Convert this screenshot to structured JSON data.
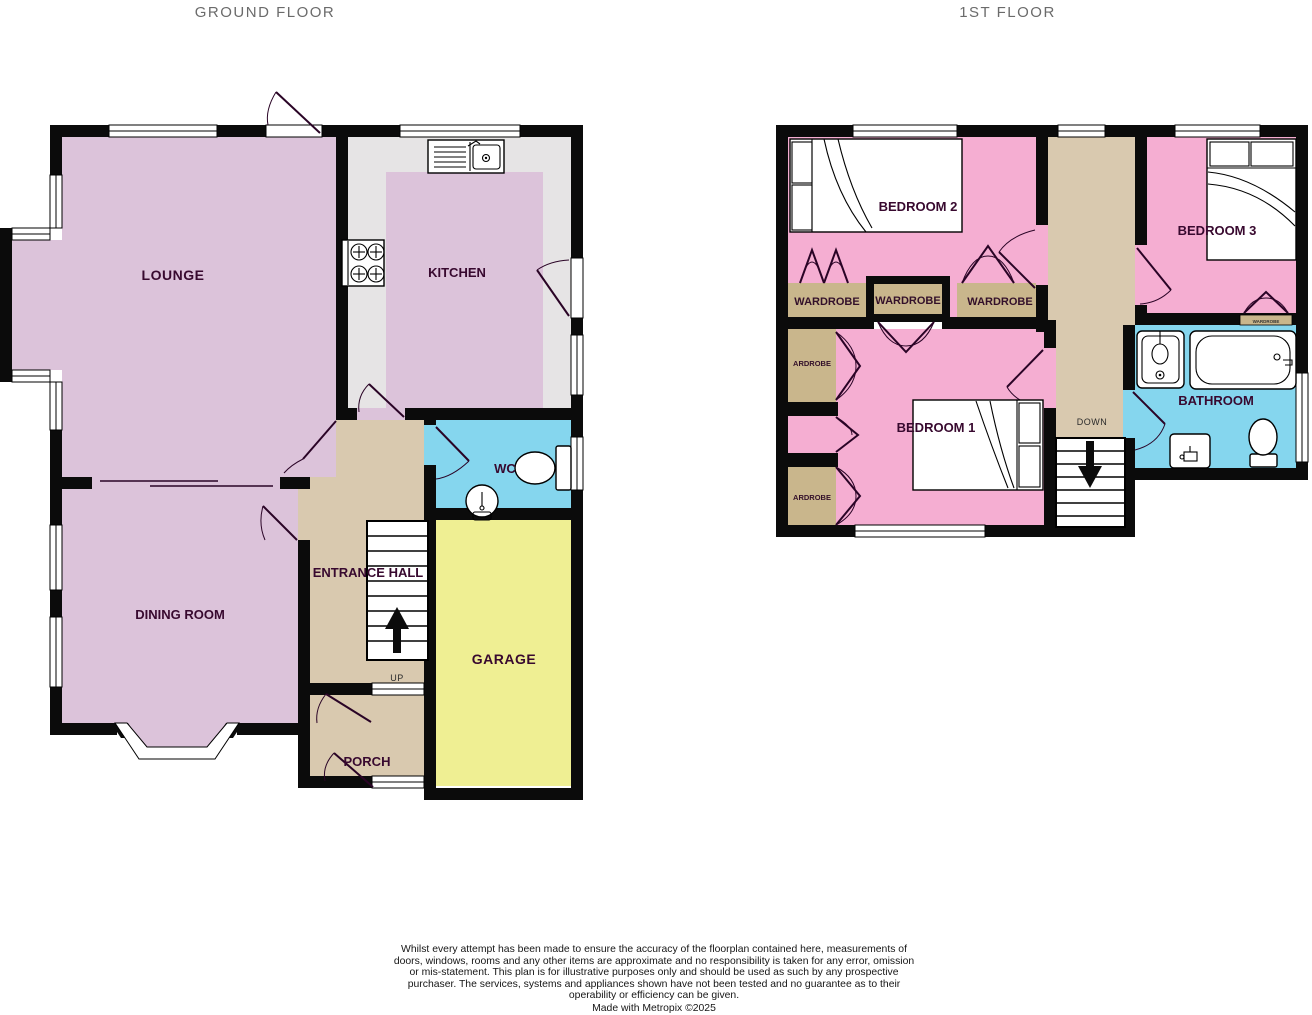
{
  "titles": {
    "ground_floor": "GROUND FLOOR",
    "first_floor": "1ST FLOOR"
  },
  "ground_floor": {
    "rooms": {
      "lounge": "LOUNGE",
      "kitchen": "KITCHEN",
      "dining_room": "DINING ROOM",
      "entrance_hall": "ENTRANCE HALL",
      "wc": "WC",
      "garage": "GARAGE",
      "porch": "PORCH"
    },
    "stairs_direction_label": "UP"
  },
  "first_floor": {
    "rooms": {
      "bedroom_1": "BEDROOM 1",
      "bedroom_2": "BEDROOM 2",
      "bedroom_3": "BEDROOM 3",
      "bathroom": "BATHROOM"
    },
    "wardrobes": {
      "row_left": "WARDROBE",
      "row_middle": "WARDROBE",
      "row_right": "WARDROBE",
      "side_upper": "ARDROBE",
      "side_lower": "ARDROBE",
      "bedroom3_cupboard": "WARDROBE"
    },
    "stairs_direction_label": "DOWN"
  },
  "footer": {
    "disclaimer": "Whilst every attempt has been made to ensure the accuracy of the floorplan contained here, measurements of doors, windows, rooms and any other items are approximate and no responsibility is taken for any error, omission or mis-statement. This plan is for illustrative purposes only and should be used as such by any prospective purchaser. The services, systems and appliances shown have not been tested and no guarantee as to their operability or efficiency can be given.",
    "credit": "Made with Metropix ©2025"
  },
  "colors": {
    "wall": "#0b0b0b",
    "room_pink_ground": "#dcc3da",
    "room_pink_first": "#f5aed2",
    "hall_tan": "#d9c9af",
    "wardrobe_tan": "#c9b68c",
    "wet_room_blue": "#85d6ee",
    "garage_yellow": "#efef93",
    "kitchen_gray": "#e6e4e5",
    "label_text": "#38092f",
    "title_text": "#6b6b6b"
  },
  "icons": [
    "bed-icon",
    "bath-icon",
    "toilet-icon",
    "sink-icon",
    "stove-icon",
    "up-arrow-icon",
    "down-arrow-icon"
  ]
}
